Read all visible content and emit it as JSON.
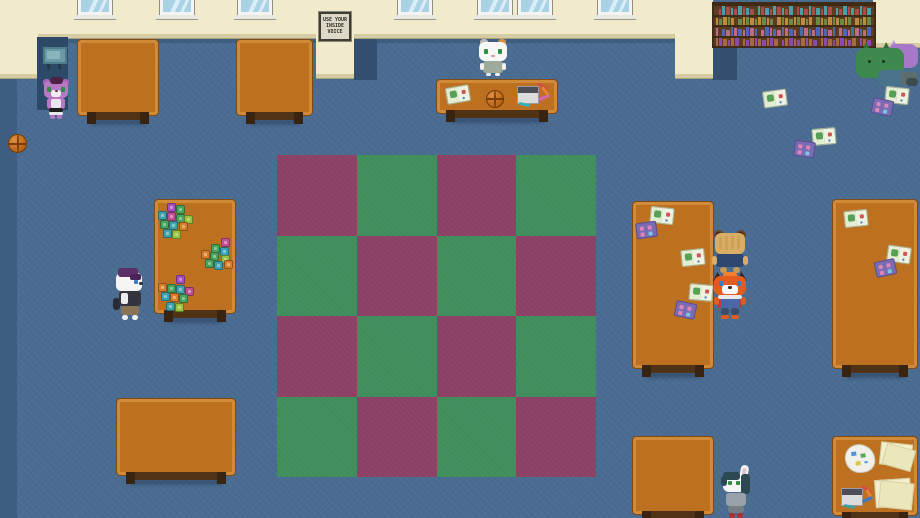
{
  "sign": {
    "lines": [
      "USE YOUR",
      "INSIDE",
      "VOICE"
    ]
  },
  "colors": {
    "floor": "#4a6c92",
    "floorStrip": "#3d5e82",
    "shadow": "#33516f",
    "alcove": "#2c4a68",
    "wall": "#f1eacb",
    "baseboard": "#d5cca4",
    "baseboard2": "#a9a07c",
    "table": "#bd7120",
    "tableEdge": "#d08a38",
    "tableOutline": "#7c4a12",
    "legs": "#503317",
    "feet": "#382410",
    "rugM": "#8e4367",
    "rugG": "#43905f",
    "shelf": "#5b3c22",
    "shelfDark": "#3f2a14",
    "glass": "#a9d2e4",
    "glassHi": "#d8eef8"
  },
  "rug": {
    "rows": 4,
    "cols": 4,
    "pattern": [
      "MGMG",
      "GMGM",
      "MGMG",
      "GMGM"
    ]
  },
  "bookshelf": {
    "rows": 4,
    "slots_per_row": 36,
    "book_palette": [
      "#b04a4a",
      "#4a6ab0",
      "#4aa06a",
      "#c08a3a",
      "#8a4ab0",
      "#4aa0a8",
      "#c06a8a",
      "#d8d0b8",
      "#6a8a4a",
      "#a86a3a"
    ]
  },
  "blocks": {
    "palette": [
      "#a84fc0",
      "#49a55e",
      "#3fa3ad",
      "#d97f2a",
      "#c44f93",
      "#9ac43f"
    ],
    "clusters": [
      {
        "x": 157,
        "y": 203,
        "blocks": [
          [
            10,
            0,
            0
          ],
          [
            19,
            2,
            1
          ],
          [
            1,
            8,
            2
          ],
          [
            10,
            9,
            4
          ],
          [
            19,
            11,
            1
          ],
          [
            27,
            12,
            5
          ],
          [
            3,
            17,
            1
          ],
          [
            12,
            18,
            2
          ],
          [
            22,
            19,
            3
          ],
          [
            6,
            26,
            2
          ],
          [
            15,
            27,
            5
          ]
        ]
      },
      {
        "x": 197,
        "y": 238,
        "blocks": [
          [
            24,
            0,
            4
          ],
          [
            14,
            6,
            1
          ],
          [
            23,
            9,
            2
          ],
          [
            4,
            12,
            3
          ],
          [
            13,
            14,
            1
          ],
          [
            24,
            17,
            5
          ],
          [
            8,
            21,
            1
          ],
          [
            17,
            23,
            2
          ],
          [
            27,
            22,
            3
          ]
        ]
      },
      {
        "x": 156,
        "y": 275,
        "blocks": [
          [
            20,
            0,
            0
          ],
          [
            2,
            8,
            3
          ],
          [
            11,
            9,
            1
          ],
          [
            20,
            10,
            2
          ],
          [
            29,
            12,
            4
          ],
          [
            5,
            17,
            2
          ],
          [
            14,
            18,
            3
          ],
          [
            23,
            19,
            1
          ],
          [
            10,
            27,
            2
          ],
          [
            19,
            28,
            5
          ]
        ]
      }
    ]
  },
  "papers": {
    "floor": [
      {
        "type": "map",
        "x": 763,
        "y": 90,
        "rot": -8
      },
      {
        "type": "map",
        "x": 885,
        "y": 87,
        "rot": 6
      },
      {
        "type": "card",
        "x": 872,
        "y": 99,
        "rot": 12
      },
      {
        "type": "map",
        "x": 812,
        "y": 128,
        "rot": -5
      },
      {
        "type": "card",
        "x": 794,
        "y": 141,
        "rot": 8
      }
    ],
    "reading_table": [
      {
        "type": "map",
        "x": 650,
        "y": 207,
        "rot": 6
      },
      {
        "type": "card",
        "x": 636,
        "y": 222,
        "rot": -8
      },
      {
        "type": "map",
        "x": 681,
        "y": 249,
        "rot": -6
      },
      {
        "type": "map",
        "x": 689,
        "y": 284,
        "rot": 5
      },
      {
        "type": "card",
        "x": 675,
        "y": 302,
        "rot": 12
      }
    ],
    "corner_table": [
      {
        "type": "map",
        "x": 844,
        "y": 210,
        "rot": -6
      },
      {
        "type": "map",
        "x": 887,
        "y": 246,
        "rot": 8
      },
      {
        "type": "card",
        "x": 875,
        "y": 260,
        "rot": -12
      }
    ],
    "activity_table": [
      {
        "type": "map",
        "x": 446,
        "y": 86,
        "rot": -10
      }
    ]
  },
  "characters": [
    {
      "id": "purple-hamster"
    },
    {
      "id": "white-cat"
    },
    {
      "id": "badger"
    },
    {
      "id": "brown-bear"
    },
    {
      "id": "fox"
    },
    {
      "id": "rabbit"
    }
  ]
}
